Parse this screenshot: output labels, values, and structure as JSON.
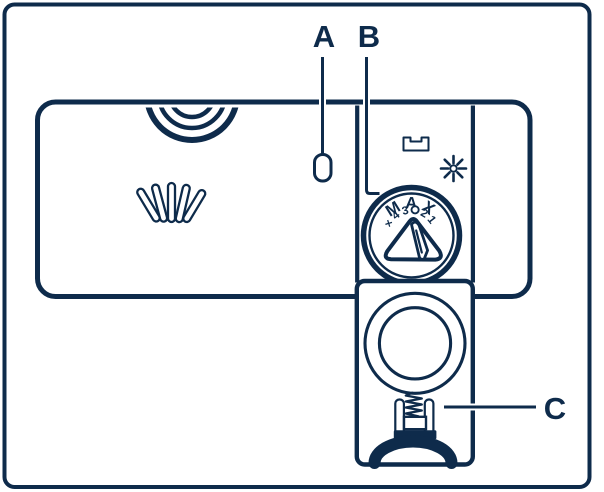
{
  "colors": {
    "line": "#0e2b4b",
    "background": "#ffffff"
  },
  "callouts": {
    "a": "A",
    "b": "B",
    "c": "C"
  },
  "dial": {
    "max_label": "MAX",
    "scale": [
      "×",
      "4",
      "3",
      "0",
      "2",
      "1"
    ]
  },
  "icons": {
    "star": "rinse-aid-star",
    "slot": "tablet-slot",
    "spring": "spring",
    "dome": "release-dome",
    "spray": "spray-lines",
    "cap": "cap-arcs"
  }
}
